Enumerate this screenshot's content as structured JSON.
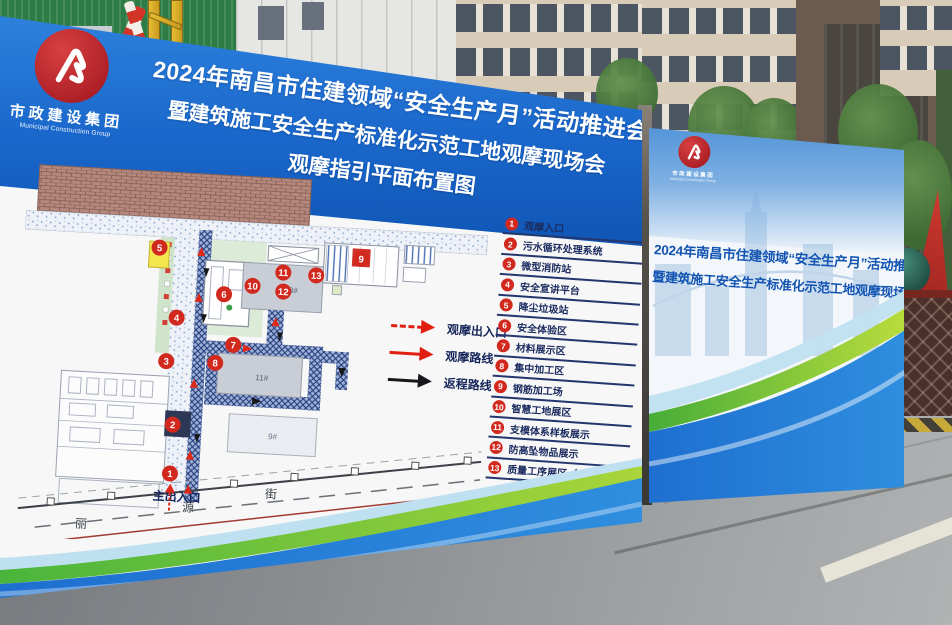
{
  "left_billboard": {
    "logo": {
      "name_cn": "市政建设集团",
      "name_en": "Municipal Construction Group"
    },
    "title_lines": [
      "2024年南昌市住建领域“安全生产月”活动推进会",
      "暨建筑施工安全生产标准化示范工地观摩现场会",
      "观摩指引平面布置图"
    ],
    "map": {
      "entrance_label": "主出入口",
      "street_chars": [
        "丽",
        "源",
        "街"
      ],
      "building_labels": {
        "b13": "13#",
        "b11": "11#",
        "b9": "9#"
      },
      "markers": {
        "m1": "1",
        "m2": "2",
        "m3": "3",
        "m4": "4",
        "m5": "5",
        "m6": "6",
        "m7": "7",
        "m8": "8",
        "m9": "9",
        "m10": "10",
        "m11": "11",
        "m12": "12",
        "m13": "13"
      },
      "route_key": [
        {
          "label": "观摩出入口"
        },
        {
          "label": "观摩路线"
        },
        {
          "label": "返程路线"
        }
      ],
      "legend": [
        {
          "num": "1",
          "label": "观摩入口"
        },
        {
          "num": "2",
          "label": "污水循环处理系统"
        },
        {
          "num": "3",
          "label": "微型消防站"
        },
        {
          "num": "4",
          "label": "安全宣讲平台"
        },
        {
          "num": "5",
          "label": "降尘垃圾站"
        },
        {
          "num": "6",
          "label": "安全体验区"
        },
        {
          "num": "7",
          "label": "材料展示区"
        },
        {
          "num": "8",
          "label": "集中加工区"
        },
        {
          "num": "9",
          "label": "钢筋加工场"
        },
        {
          "num": "10",
          "label": "智慧工地展区"
        },
        {
          "num": "11",
          "label": "支模体系样板展示"
        },
        {
          "num": "12",
          "label": "防高坠物品展示"
        },
        {
          "num": "13",
          "label": "质量工序展区（二楼）"
        }
      ]
    }
  },
  "right_billboard": {
    "logo": {
      "name_cn": "市政建设集团",
      "name_en": "Municipal Construction Group"
    },
    "title_lines": [
      "2024年南昌市住建领域“安全生产月”活动推进会",
      "暨建筑施工安全生产标准化示范工地观摩现场会"
    ]
  },
  "colors": {
    "board_blue": "#1a67cb",
    "marker_red": "#d2291f",
    "legend_navy": "#1c2c60",
    "title_blue": "#1254b2",
    "wave_green": "#55b83c"
  }
}
